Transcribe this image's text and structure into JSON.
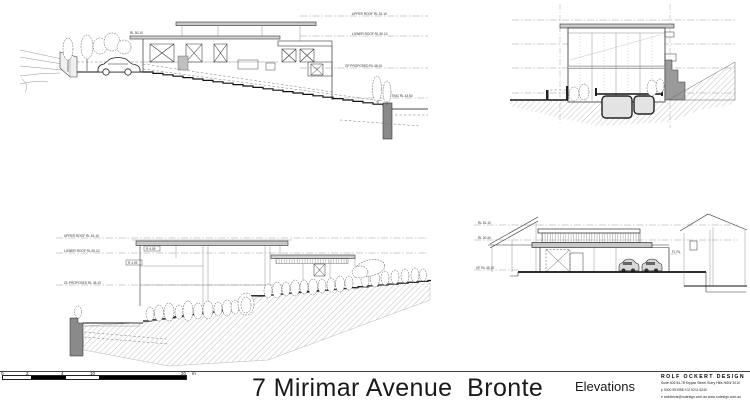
{
  "sheet": {
    "title": "7 Mirimar Avenue  Bronte",
    "drawing_name": "Elevations"
  },
  "title_block": {
    "firm": "ROLF OCKERT DESIGN",
    "address_line": "Suite 406  54-78 Kippax Street  Surry Hills  NSW  2010",
    "contact_line": "p 0400 991958   f 02 9211 5240",
    "web_line": "e architects@rodesign.com.au   www.rodesign.com.au"
  },
  "scale_bar": {
    "labels": {
      "zero": "0",
      "two": "2",
      "four": "4",
      "ten": "10",
      "twenty": "20"
    },
    "unit": "m"
  },
  "north_elevation": {
    "level1": "UPPER ROOF RL 51.10",
    "level2": "LOWER ROOF RL 50.10",
    "level3": "GF PROPOSED RL 46.10",
    "level4": "EXISTING RL 43.60",
    "note": "RL 50.10"
  },
  "side_elevation": {
    "level1": "UPPER ROOF RL 51.10",
    "level2": "LOWER ROOF RL 50.10",
    "level3": "GL PROPOSED RL 45.10",
    "note1": "R 4.09",
    "note2": "R 4.09"
  },
  "street_elevation": {
    "level1": "RL 51.10",
    "level2": "RL 50.40",
    "level3": "GF RL 45.10",
    "note_right": "FL RL"
  }
}
